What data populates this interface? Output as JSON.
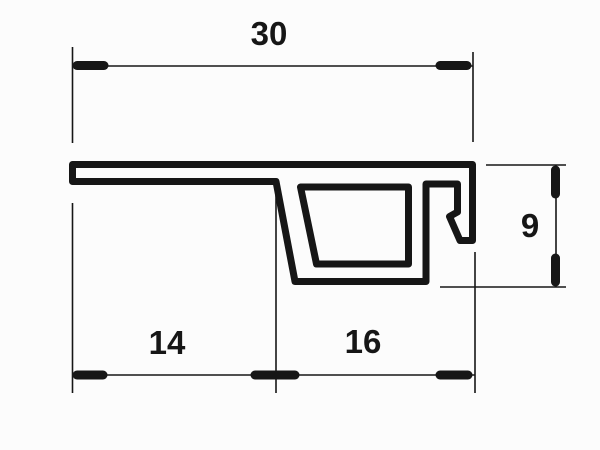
{
  "drawing": {
    "kind": "profile-cross-section",
    "dimensions": {
      "total_width": "30",
      "flange_width": "14",
      "channel_width": "16",
      "height": "9"
    },
    "colors": {
      "line": "#161616",
      "background": "#fcfcfc"
    }
  }
}
